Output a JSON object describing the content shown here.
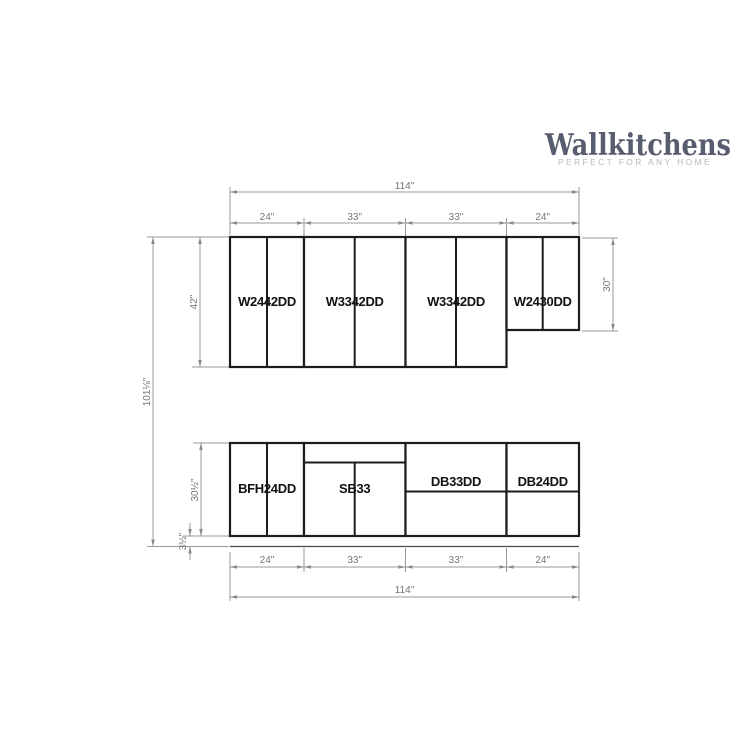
{
  "logo": {
    "name": "Wallkitchens",
    "tagline": "PERFECT FOR ANY HOME"
  },
  "colors": {
    "logo": "#575c6e",
    "logo_tagline": "#b5b7bf",
    "cabinet_outline": "#1c1c1c",
    "dimension_line": "#9a9a9a",
    "dimension_text": "#757575",
    "label_text": "#121212",
    "background": "#ffffff"
  },
  "wall_cabinets": [
    {
      "label": "W2442DD",
      "width": "24\"",
      "height": "42\""
    },
    {
      "label": "W3342DD",
      "width": "33\"",
      "height": "42\""
    },
    {
      "label": "W3342DD",
      "width": "33\"",
      "height": "42\""
    },
    {
      "label": "W2430DD",
      "width": "24\"",
      "height": "30\""
    }
  ],
  "base_cabinets": [
    {
      "label": "BFH24DD",
      "width": "24\""
    },
    {
      "label": "SB33",
      "width": "33\""
    },
    {
      "label": "DB33DD",
      "width": "33\""
    },
    {
      "label": "DB24DD",
      "width": "24\""
    }
  ],
  "dimensions": {
    "top_total": "114\"",
    "top_segments": [
      "24\"",
      "33\"",
      "33\"",
      "24\""
    ],
    "bottom_segments": [
      "24\"",
      "33\"",
      "33\"",
      "24\""
    ],
    "bottom_total": "114\"",
    "overall_height": "101⅛\"",
    "wall_cabinet_height": "42\"",
    "wall_cabinet_right_height": "30\"",
    "base_cabinet_height": "30½\"",
    "toe_kick_height": "3½\""
  }
}
